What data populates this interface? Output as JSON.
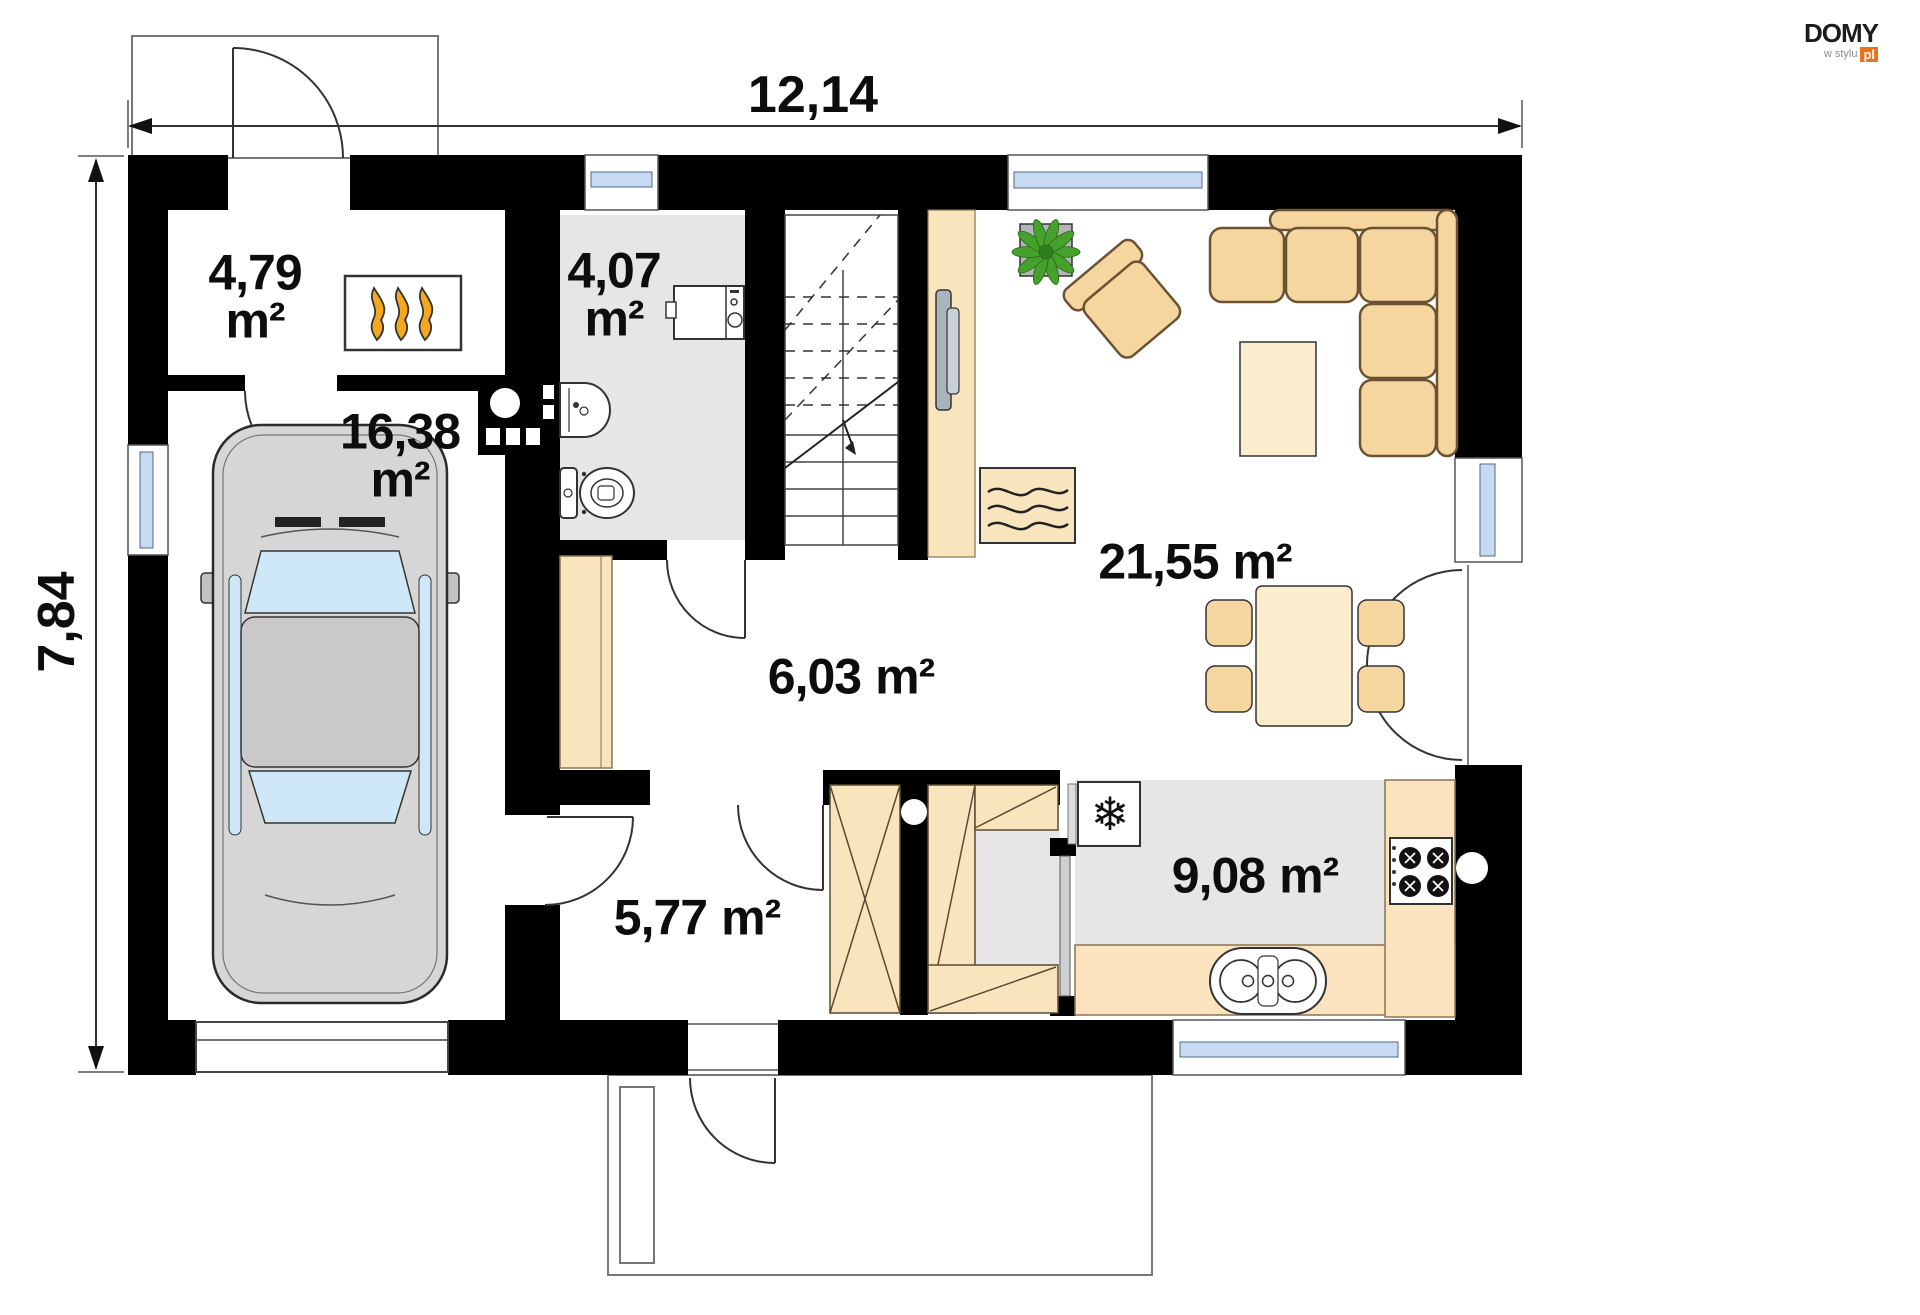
{
  "logo": {
    "brand": "DOMY",
    "tagline": "w stylu",
    "suffix": "pl"
  },
  "dimensions": {
    "width": "12,14",
    "height": "7,84"
  },
  "rooms": {
    "boiler_room": {
      "area": "4,79",
      "unit": "m²"
    },
    "bathroom": {
      "area": "4,07",
      "unit": "m²"
    },
    "garage": {
      "area": "16,38",
      "unit": "m²"
    },
    "hall": {
      "area": "6,03",
      "unit": "m²"
    },
    "vestibule": {
      "area": "5,77",
      "unit": "m²"
    },
    "living_dining": {
      "area": "21,55",
      "unit": "m²"
    },
    "kitchen": {
      "area": "9,08",
      "unit": "m²"
    }
  },
  "icons": {
    "fridge": "❄"
  },
  "colors": {
    "wall": "#000000",
    "floor_gray": "#e6e6e6",
    "furniture_tan": "#f6d69f",
    "furniture_light": "#fbeccd",
    "cabinet_tan": "#f8e4bd",
    "counter_tan": "#fbe3c0",
    "window_glass": "#c7daf2",
    "flame_orange": "#f5a81c",
    "plant_green": "#46a12c",
    "logo_orange": "#e8731a",
    "car_body": "#d6d6d6",
    "car_glass": "#cfe8f7"
  }
}
